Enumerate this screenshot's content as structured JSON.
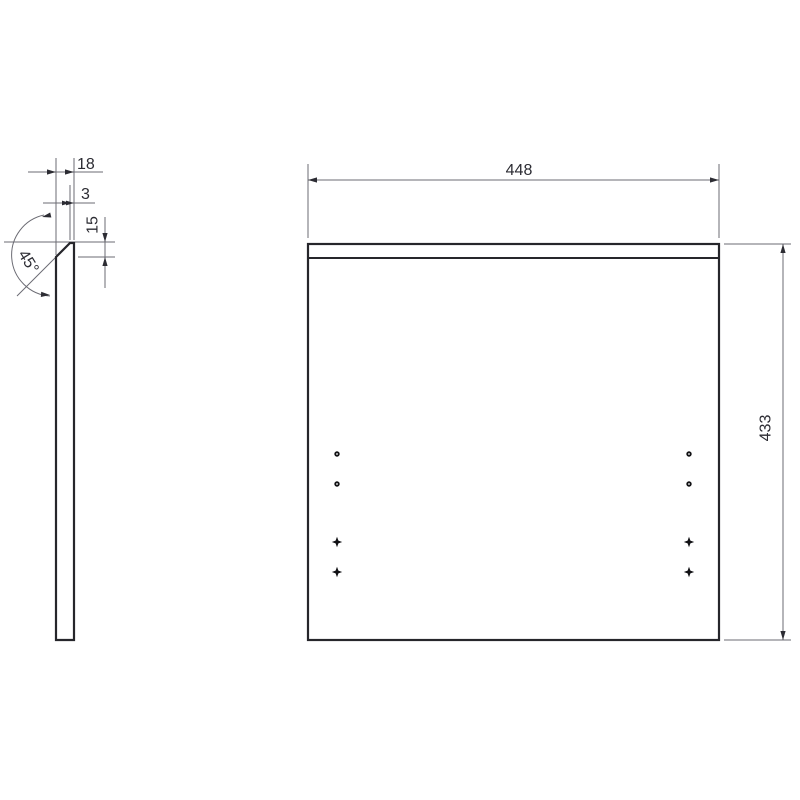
{
  "page": {
    "background_color": "#ffffff",
    "object_line_color": "#26262b",
    "dimension_line_color": "#6b6b73",
    "text_color": "#2c2c33"
  },
  "drawing": {
    "type": "technical-drawing",
    "side_view": {
      "dimensions": {
        "total_thickness": "18",
        "top_edge_thickness": "3",
        "chamfer_height": "15",
        "chamfer_angle": "45°"
      }
    },
    "front_view": {
      "dimensions": {
        "width": "448",
        "height": "433"
      },
      "hole_markers": {
        "round_count": 4,
        "star_count": 4
      }
    }
  }
}
